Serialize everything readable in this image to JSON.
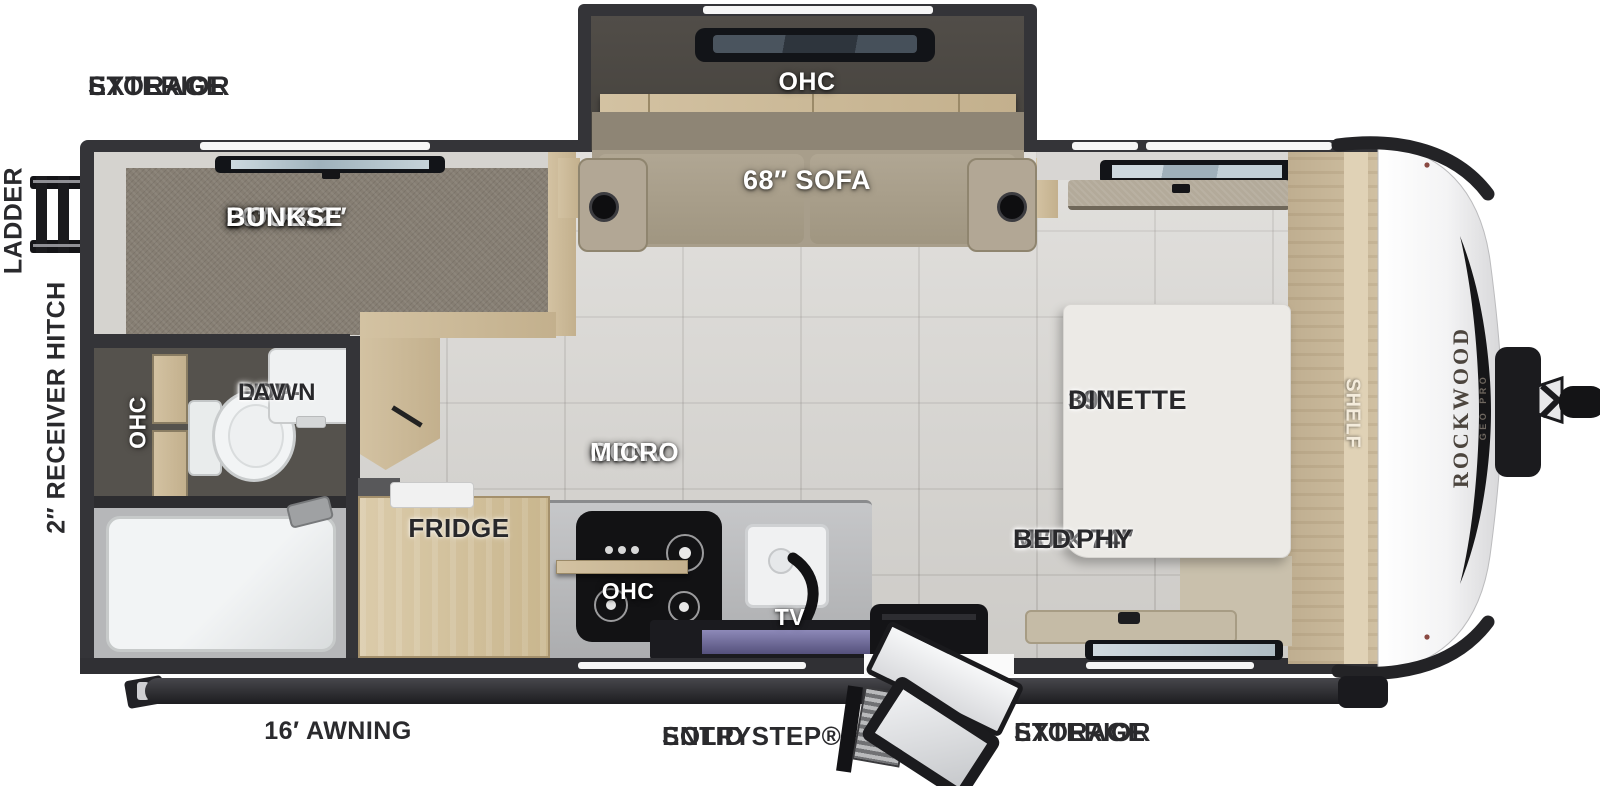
{
  "brand": {
    "name": "ROCKWOOD",
    "sub": "GEO PRO"
  },
  "exterior": {
    "storage_top_l1": "EXTERIOR",
    "storage_top_l2": "STORAGE",
    "ladder": "LADDER",
    "receiver_hitch": "2″ RECEIVER HITCH",
    "awning": "16′ AWNING",
    "entry_l1": "SOLID STEP®",
    "entry_l2": "ENTRY",
    "storage_bottom_l1": "EXTERIOR",
    "storage_bottom_l2": "STORAGE"
  },
  "interior": {
    "bunks_l1": "26″ × 72″",
    "bunks_l2": "DOUBLE",
    "bunks_l3": "BUNKS",
    "slide_ohc": "OHC",
    "sofa": "68″ SOFA",
    "bath_ohc": "OHC",
    "lav_l1": "FLIP-",
    "lav_l2": "DOWN",
    "lav_l3": "LAV",
    "fridge": "FRIDGE",
    "micro_l1": "CONV",
    "micro_l2": "MICRO",
    "kitchen_ohc": "OHC",
    "tv": "TV",
    "dinette_l1": "39″",
    "dinette_l2": "DINETTE",
    "murphy_l1": "54″ × 74″",
    "murphy_l2": "MURPHY",
    "murphy_l3": "BED",
    "shelf": "SHELF"
  },
  "colors": {
    "wall": "#343438",
    "floor_tile": "#d8d6d2",
    "bunk_carpet": "#867e73",
    "cabinet_wood": "#cdbb9a",
    "sofa_fabric": "#a89e8b",
    "accent_black": "#1b1b1e",
    "label_dark": "#28282b",
    "label_white": "#ffffff"
  }
}
